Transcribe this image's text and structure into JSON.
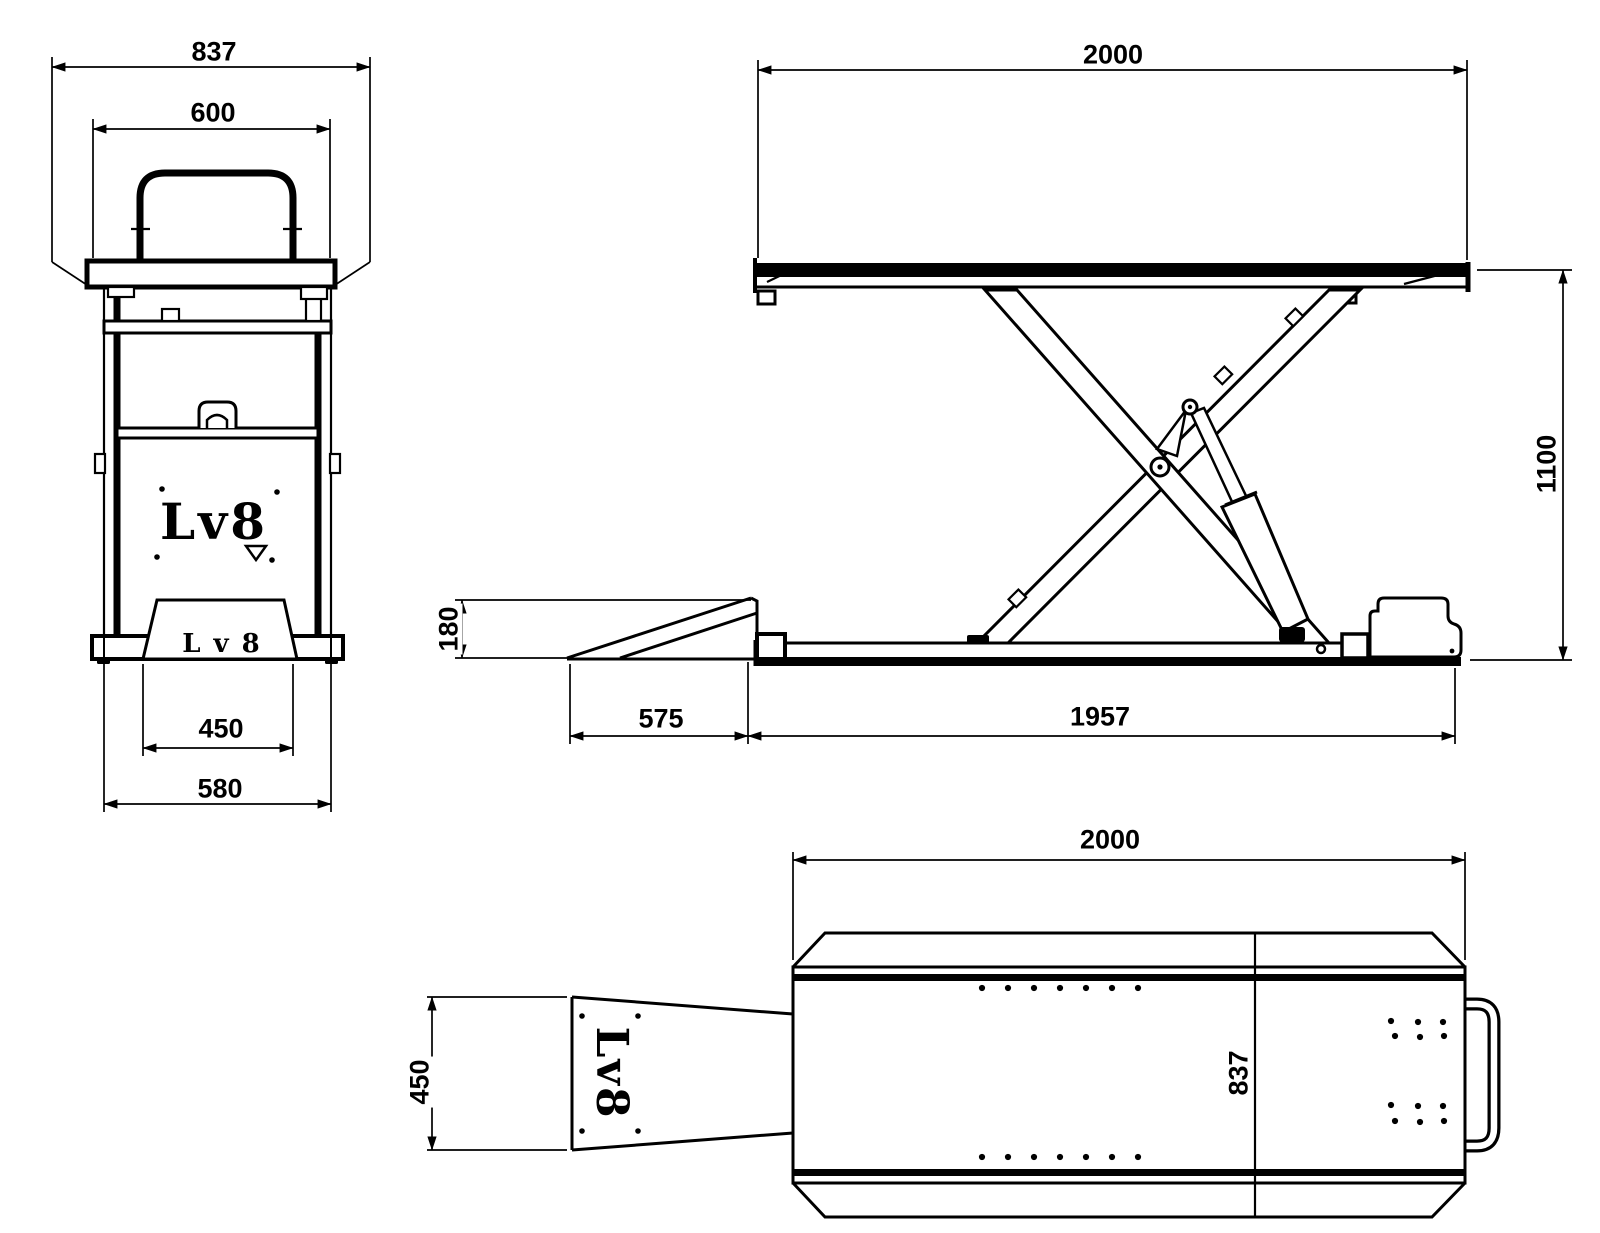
{
  "drawing": {
    "front_view": {
      "dim_overall_width": "837",
      "dim_platform_width": "600",
      "dim_ramp_width": "450",
      "dim_base_width": "580",
      "logo_center": "Lv8",
      "logo_ramp": "Lv8"
    },
    "side_view": {
      "dim_platform_length": "2000",
      "dim_lift_height": "1100",
      "dim_ramp_height": "180",
      "dim_ramp_length": "575",
      "dim_base_length": "1957"
    },
    "top_view": {
      "dim_platform_length": "2000",
      "dim_ramp_width": "450",
      "dim_platform_width": "837",
      "logo_ramp": "Lv8"
    }
  }
}
